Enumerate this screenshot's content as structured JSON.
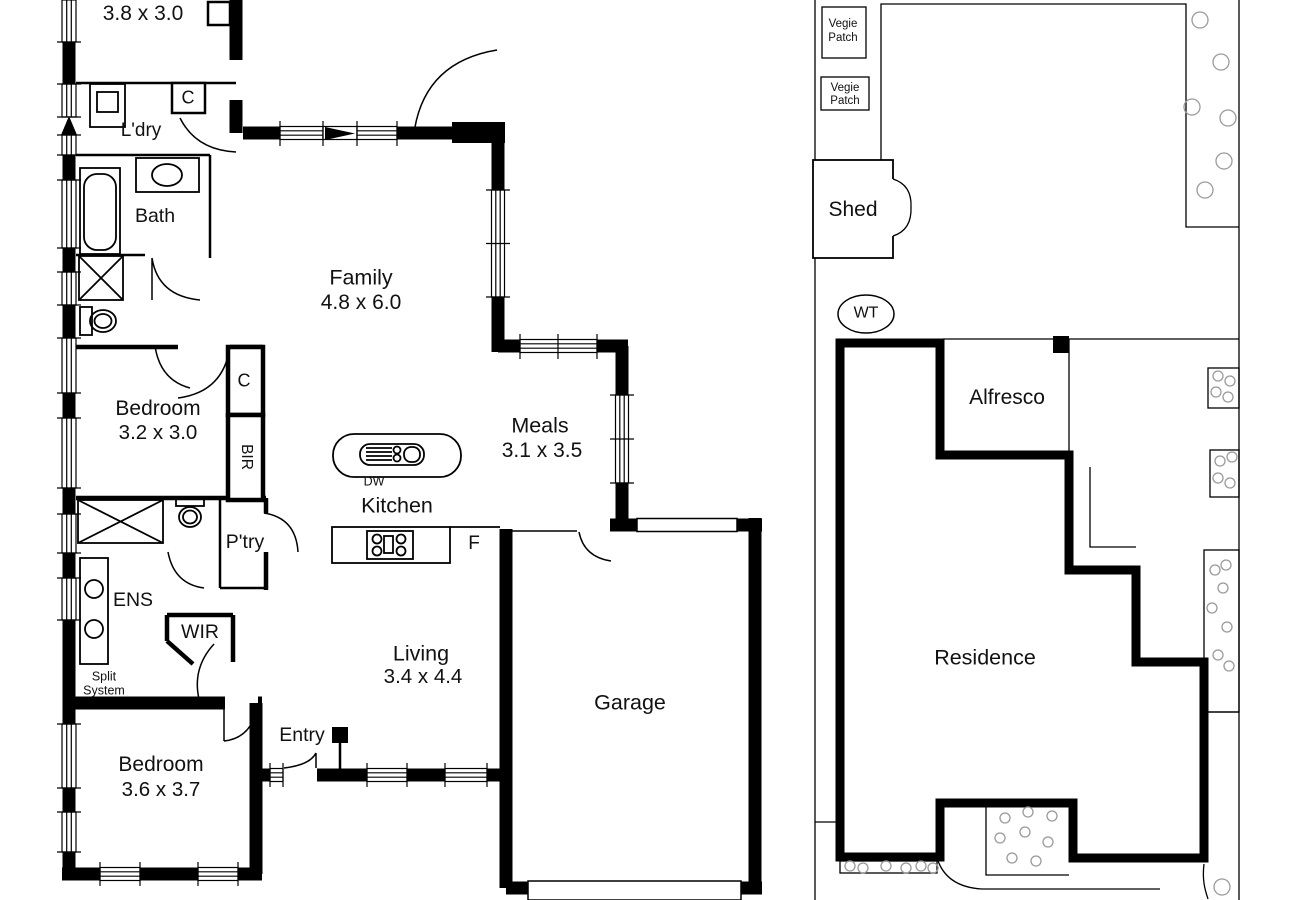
{
  "floor_plan": {
    "rooms": {
      "top_room": {
        "dims": "3.8 x 3.0"
      },
      "laundry": {
        "label": "L'dry"
      },
      "closet_top": {
        "label": "C"
      },
      "bath": {
        "label": "Bath"
      },
      "bedroom_2": {
        "label": "Bedroom",
        "dims": "3.2 x 3.0"
      },
      "closet_bedroom_2": {
        "label": "C"
      },
      "robe": {
        "label": "BIR"
      },
      "family": {
        "label": "Family",
        "dims": "4.8 x 6.0"
      },
      "meals": {
        "label": "Meals",
        "dims": "3.1 x 3.5"
      },
      "kitchen": {
        "label": "Kitchen"
      },
      "dishwasher": {
        "label": "DW"
      },
      "fridge": {
        "label": "F"
      },
      "pantry": {
        "label": "P'try"
      },
      "ensuite": {
        "label": "ENS"
      },
      "wir": {
        "label": "WIR"
      },
      "split_system": {
        "line1": "Split",
        "line2": "System"
      },
      "living": {
        "label": "Living",
        "dims": "3.4 x 4.4"
      },
      "entry": {
        "label": "Entry"
      },
      "bedroom_3": {
        "label": "Bedroom",
        "dims": "3.6 x 3.7"
      },
      "garage": {
        "label": "Garage"
      }
    }
  },
  "site_plan": {
    "vegie_patch_1": {
      "line1": "Vegie",
      "line2": "Patch"
    },
    "vegie_patch_2": {
      "line1": "Vegie",
      "line2": "Patch"
    },
    "shed": {
      "label": "Shed"
    },
    "water_tank": {
      "label": "WT"
    },
    "alfresco": {
      "label": "Alfresco"
    },
    "residence": {
      "label": "Residence"
    }
  },
  "colors": {
    "wall": "#000000",
    "background": "#ffffff",
    "shrub": "#9a9a9a"
  }
}
